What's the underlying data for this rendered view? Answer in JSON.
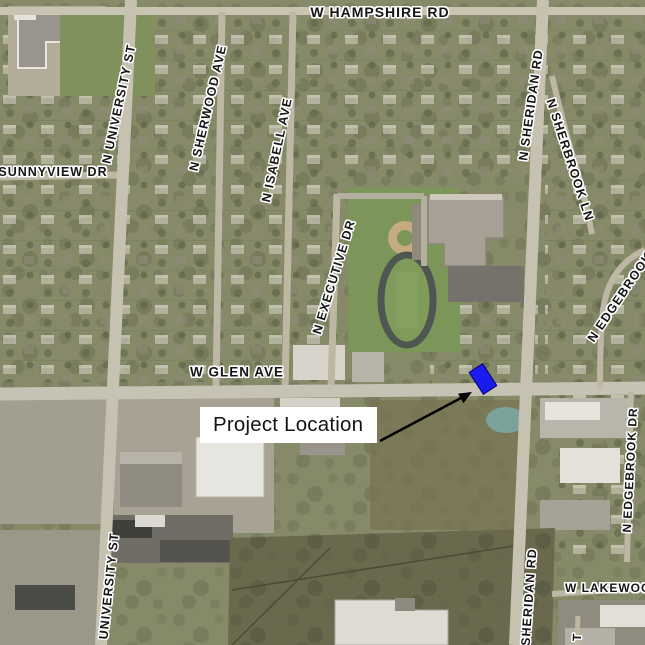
{
  "map": {
    "type": "aerial-satellite",
    "description": "Aerial photo map of project vicinity with labeled streets",
    "street_labels": [
      {
        "id": "w-hampshire-rd",
        "text": "W HAMPSHIRE RD",
        "x": 380,
        "y": 12,
        "rotate": 0,
        "size": 14
      },
      {
        "id": "n-university-st",
        "text": "N UNIVERSITY ST",
        "x": 119,
        "y": 104,
        "rotate": -78,
        "size": 12.5
      },
      {
        "id": "n-sherwood-ave",
        "text": "N SHERWOOD AVE",
        "x": 208,
        "y": 108,
        "rotate": -77,
        "size": 12.5
      },
      {
        "id": "n-isabell-ave",
        "text": "N ISABELL AVE",
        "x": 277,
        "y": 150,
        "rotate": -78,
        "size": 12.5
      },
      {
        "id": "sunnyview-dr",
        "text": "SUNNYVIEW DR",
        "x": 53,
        "y": 172,
        "rotate": 0,
        "size": 12.5
      },
      {
        "id": "n-executive-dr",
        "text": "N EXECUTIVE DR",
        "x": 334,
        "y": 277,
        "rotate": -73,
        "size": 12.5
      },
      {
        "id": "n-sheridan-rd",
        "text": "N SHERIDAN RD",
        "x": 531,
        "y": 105,
        "rotate": -82,
        "size": 12.5
      },
      {
        "id": "n-sherbrook-ln",
        "text": "N SHERBROOK LN",
        "x": 570,
        "y": 160,
        "rotate": 72,
        "size": 12.5
      },
      {
        "id": "n-edgebrook-upper",
        "text": "N EDGEBROOK",
        "x": 620,
        "y": 297,
        "rotate": -56,
        "size": 12.5
      },
      {
        "id": "w-glen-ave",
        "text": "W GLEN AVE",
        "x": 237,
        "y": 372,
        "rotate": 0,
        "size": 13.5
      },
      {
        "id": "n-edgebrook-dr",
        "text": "N EDGEBROOK DR",
        "x": 630,
        "y": 470,
        "rotate": -87,
        "size": 12
      },
      {
        "id": "university-st-south",
        "text": "UNIVERSITY ST",
        "x": 109,
        "y": 586,
        "rotate": -84,
        "size": 12.5
      },
      {
        "id": "sheridan-rd-south",
        "text": "SHERIDAN RD",
        "x": 529,
        "y": 597,
        "rotate": -86,
        "size": 12.5
      },
      {
        "id": "w-lakewood",
        "text": "W LAKEWOOD",
        "x": 613,
        "y": 588,
        "rotate": 0,
        "size": 12
      },
      {
        "id": "t-partial",
        "text": "T",
        "x": 577,
        "y": 637,
        "rotate": -88,
        "size": 12
      }
    ],
    "annotation": {
      "label": "Project Location",
      "marker_color": "#1b1bf0",
      "marker_border_color": "#000066",
      "arrow_color": "#000000",
      "box_background": "#ffffff",
      "label_color": "#141414"
    }
  }
}
